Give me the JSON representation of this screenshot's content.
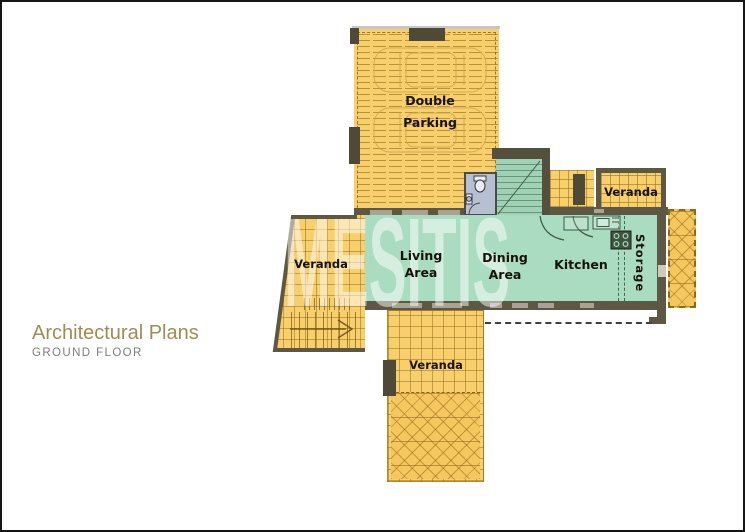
{
  "title_block": {
    "title": "Architectural Plans",
    "subtitle": "GROUND FLOOR"
  },
  "watermark": "MESITIS",
  "rooms": {
    "parking": {
      "label": "Double Parking"
    },
    "living": {
      "label": "Living Area"
    },
    "dining": {
      "label": "Dining Area"
    },
    "kitchen": {
      "label": "Kitchen"
    },
    "storage": {
      "label": "Storage"
    },
    "veranda_left": {
      "label": "Veranda"
    },
    "veranda_top_right": {
      "label": "Veranda"
    },
    "veranda_bottom": {
      "label": "Veranda"
    }
  },
  "colors": {
    "accent_gold": "#a28b52",
    "subtitle_gray": "#7c7c7c",
    "floor_yellow": "#f7cf6d",
    "floor_green": "#aadcc1",
    "stair_green": "#9fd2b5",
    "hatch_orange": "#f4c75f",
    "wall_dark": "#5d5844",
    "wc_blue": "#b7c0d3",
    "watermark_white": "#ffffff"
  }
}
